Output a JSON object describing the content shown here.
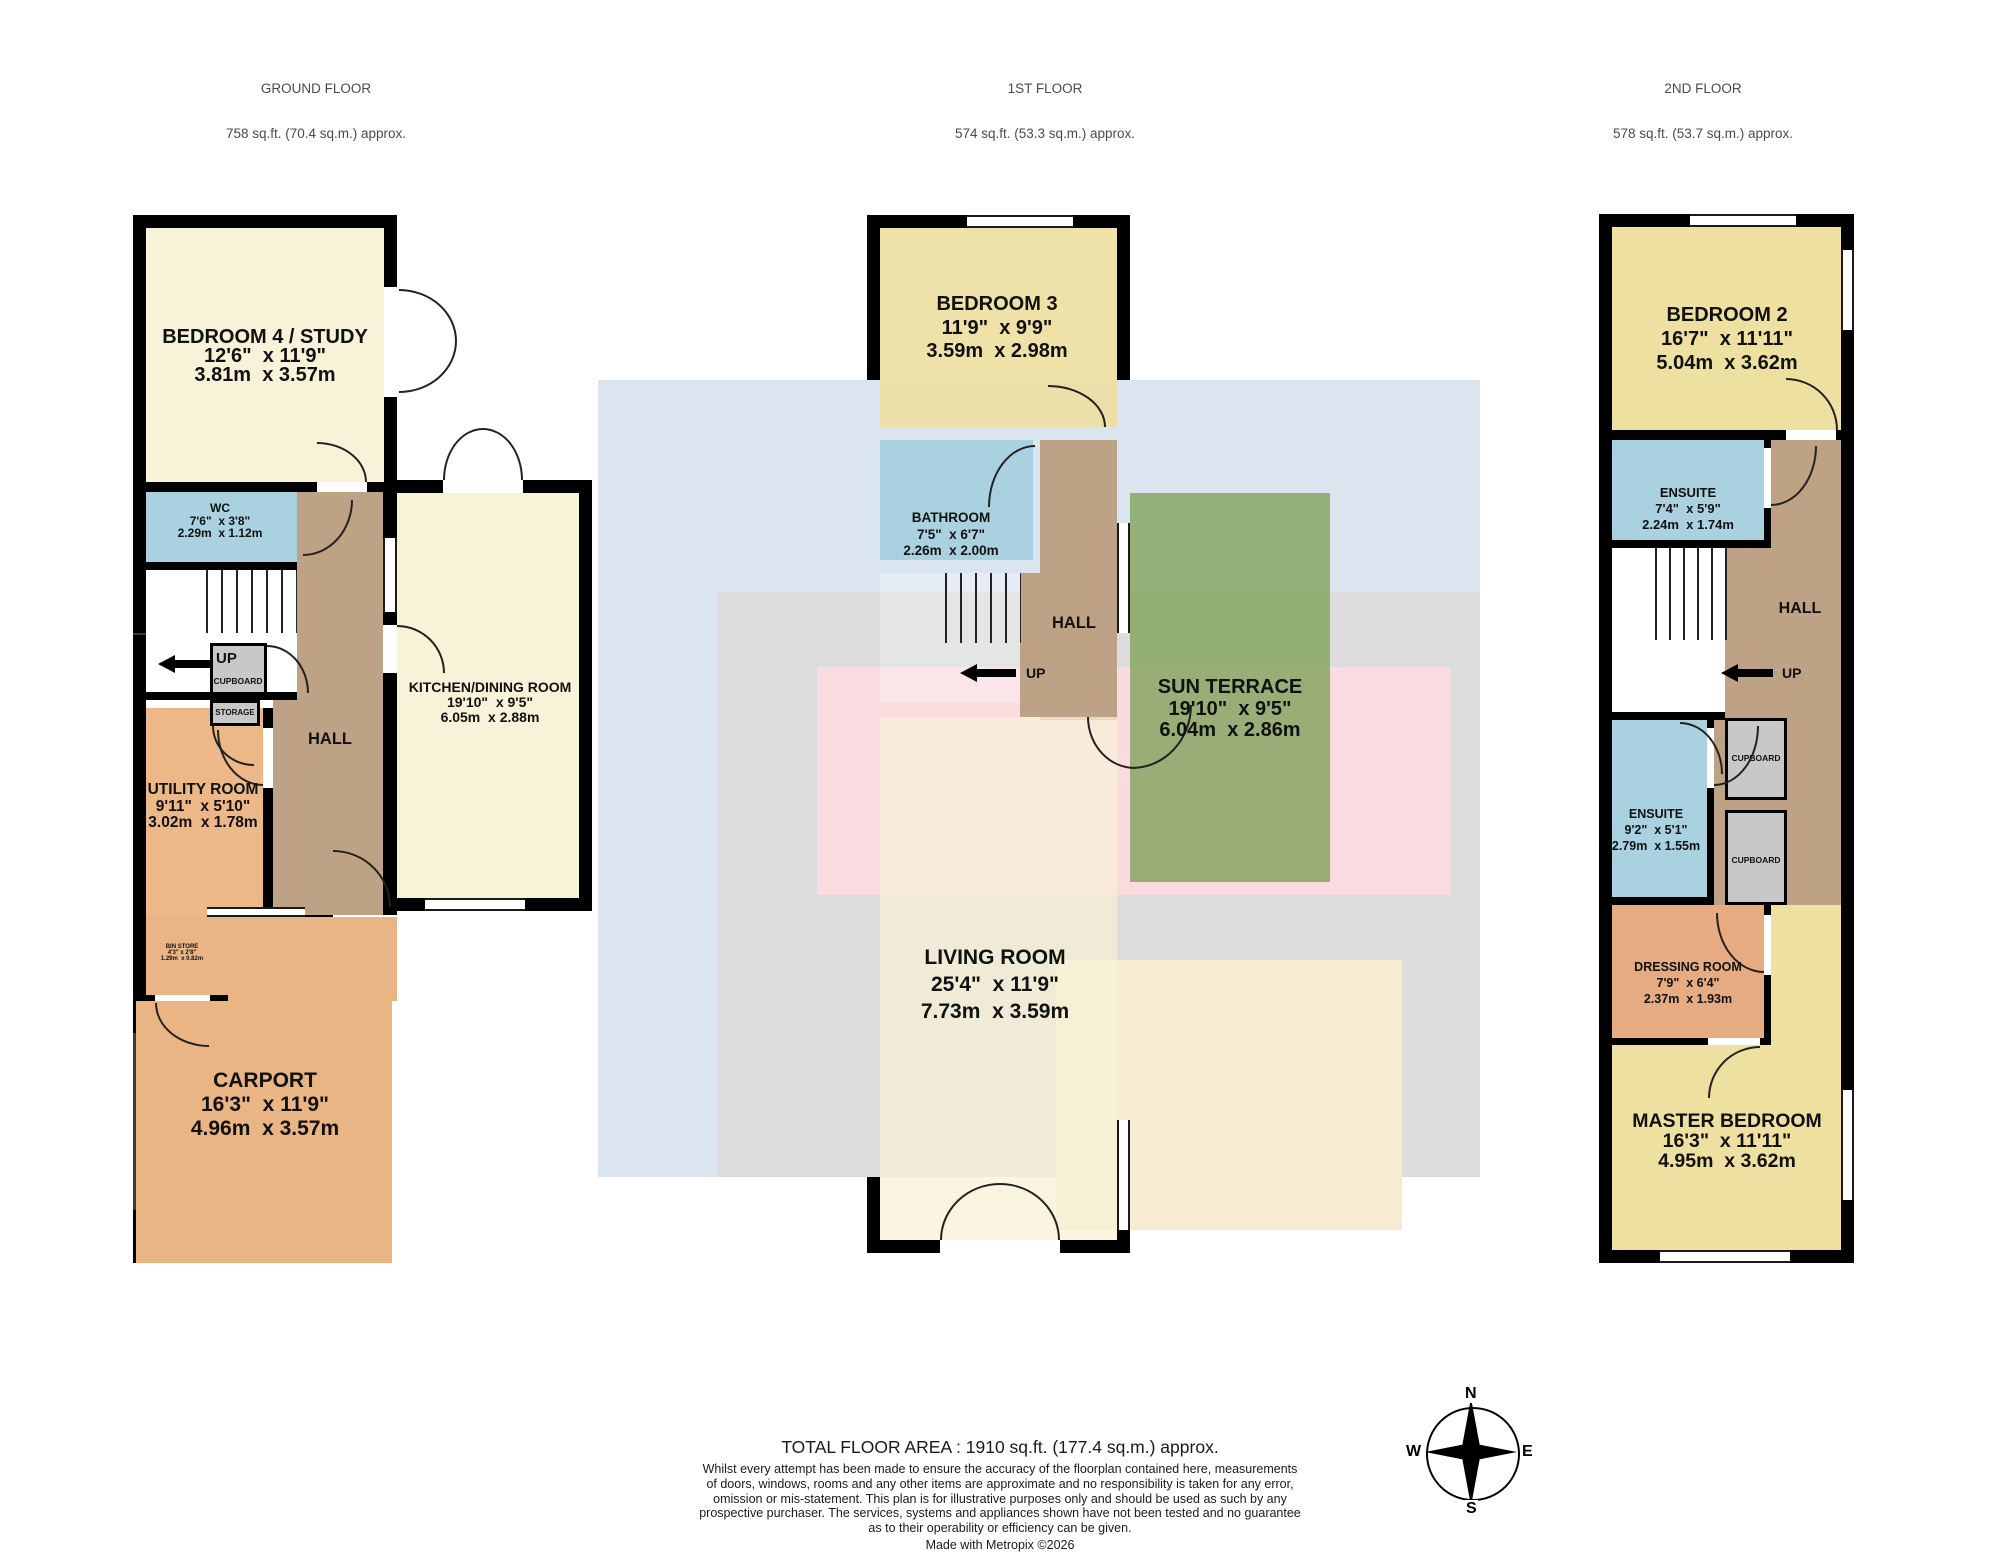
{
  "page": {
    "total_area": "TOTAL FLOOR AREA : 1910 sq.ft. (177.4 sq.m.) approx.",
    "disclaimer_lines": [
      "Whilst every attempt has been made to ensure the accuracy of the floorplan contained here, measurements",
      "of doors, windows, rooms and any other items are approximate and no responsibility is taken for any error,",
      "omission or mis-statement. This plan is for illustrative purposes only and should be used as such by any",
      "prospective purchaser. The services, systems and appliances shown have not been tested and no guarantee",
      "as to their operability or efficiency can be given."
    ],
    "made_with": "Made with Metropix ©2026"
  },
  "compass": {
    "n": "N",
    "s": "S",
    "e": "E",
    "w": "W"
  },
  "colors": {
    "wall": "#000000",
    "cream_room": "#f7f2d8",
    "yellow_room": "#eee0a0",
    "blue_room": "#aad1df",
    "hall_brown": "#bda285",
    "orange_room": "#eab584",
    "terrace_green": "#8fae73",
    "cupboard_gray": "#c8c8c8",
    "ghost_blue": "#dbe5ef",
    "ghost_gray": "#dcdcdc",
    "ghost_pink": "#fadce0",
    "ghost_cream": "#f7ecd2"
  },
  "floors": {
    "ground": {
      "title": "GROUND FLOOR",
      "area": "758 sq.ft. (70.4 sq.m.) approx.",
      "rooms": {
        "bedroom4": {
          "name": "BEDROOM 4 / STUDY",
          "ft": "12'6\"  x 11'9\"",
          "m": "3.81m  x 3.57m"
        },
        "wc": {
          "name": "WC",
          "ft": "7'6\"  x 3'8\"",
          "m": "2.29m  x 1.12m"
        },
        "kitchen": {
          "name": "KITCHEN/DINING ROOM",
          "ft": "19'10\"  x 9'5\"",
          "m": "6.05m  x 2.88m"
        },
        "hall": {
          "name": "HALL"
        },
        "utility": {
          "name": "UTILITY ROOM",
          "ft": "9'11\"  x 5'10\"",
          "m": "3.02m  x 1.78m"
        },
        "binstore": {
          "name": "BIN STORE",
          "ft": "4'3\" x 2'8\"",
          "m": "1.29m  x 0.82m"
        },
        "carport": {
          "name": "CARPORT",
          "ft": "16'3\"  x 11'9\"",
          "m": "4.96m  x 3.57m"
        },
        "cupboard": {
          "name": "CUPBOARD"
        },
        "storage": {
          "name": "STORAGE"
        },
        "up": {
          "name": "UP"
        }
      }
    },
    "first": {
      "title": "1ST FLOOR",
      "area": "574 sq.ft. (53.3 sq.m.) approx.",
      "rooms": {
        "bedroom3": {
          "name": "BEDROOM 3",
          "ft": "11'9\"  x 9'9\"",
          "m": "3.59m  x 2.98m"
        },
        "bathroom": {
          "name": "BATHROOM",
          "ft": "7'5\"  x 6'7\"",
          "m": "2.26m  x 2.00m"
        },
        "hall": {
          "name": "HALL"
        },
        "sunterrace": {
          "name": "SUN TERRACE",
          "ft": "19'10\"  x 9'5\"",
          "m": "6.04m  x 2.86m"
        },
        "living": {
          "name": "LIVING ROOM",
          "ft": "25'4\"  x 11'9\"",
          "m": "7.73m  x 3.59m"
        },
        "up": {
          "name": "UP"
        }
      }
    },
    "second": {
      "title": "2ND FLOOR",
      "area": "578 sq.ft. (53.7 sq.m.) approx.",
      "rooms": {
        "bedroom2": {
          "name": "BEDROOM 2",
          "ft": "16'7\"  x 11'11\"",
          "m": "5.04m  x 3.62m"
        },
        "ensuite1": {
          "name": "ENSUITE",
          "ft": "7'4\"  x 5'9\"",
          "m": "2.24m  x 1.74m"
        },
        "hall": {
          "name": "HALL"
        },
        "ensuite2": {
          "name": "ENSUITE",
          "ft": "9'2\"  x 5'1\"",
          "m": "2.79m  x 1.55m"
        },
        "cupboard1": {
          "name": "CUPBOARD"
        },
        "cupboard2": {
          "name": "CUPBOARD"
        },
        "dressing": {
          "name": "DRESSING ROOM",
          "ft": "7'9\"  x 6'4\"",
          "m": "2.37m  x 1.93m"
        },
        "master": {
          "name": "MASTER BEDROOM",
          "ft": "16'3\"  x 11'11\"",
          "m": "4.95m  x 3.62m"
        },
        "up": {
          "name": "UP"
        }
      }
    }
  }
}
